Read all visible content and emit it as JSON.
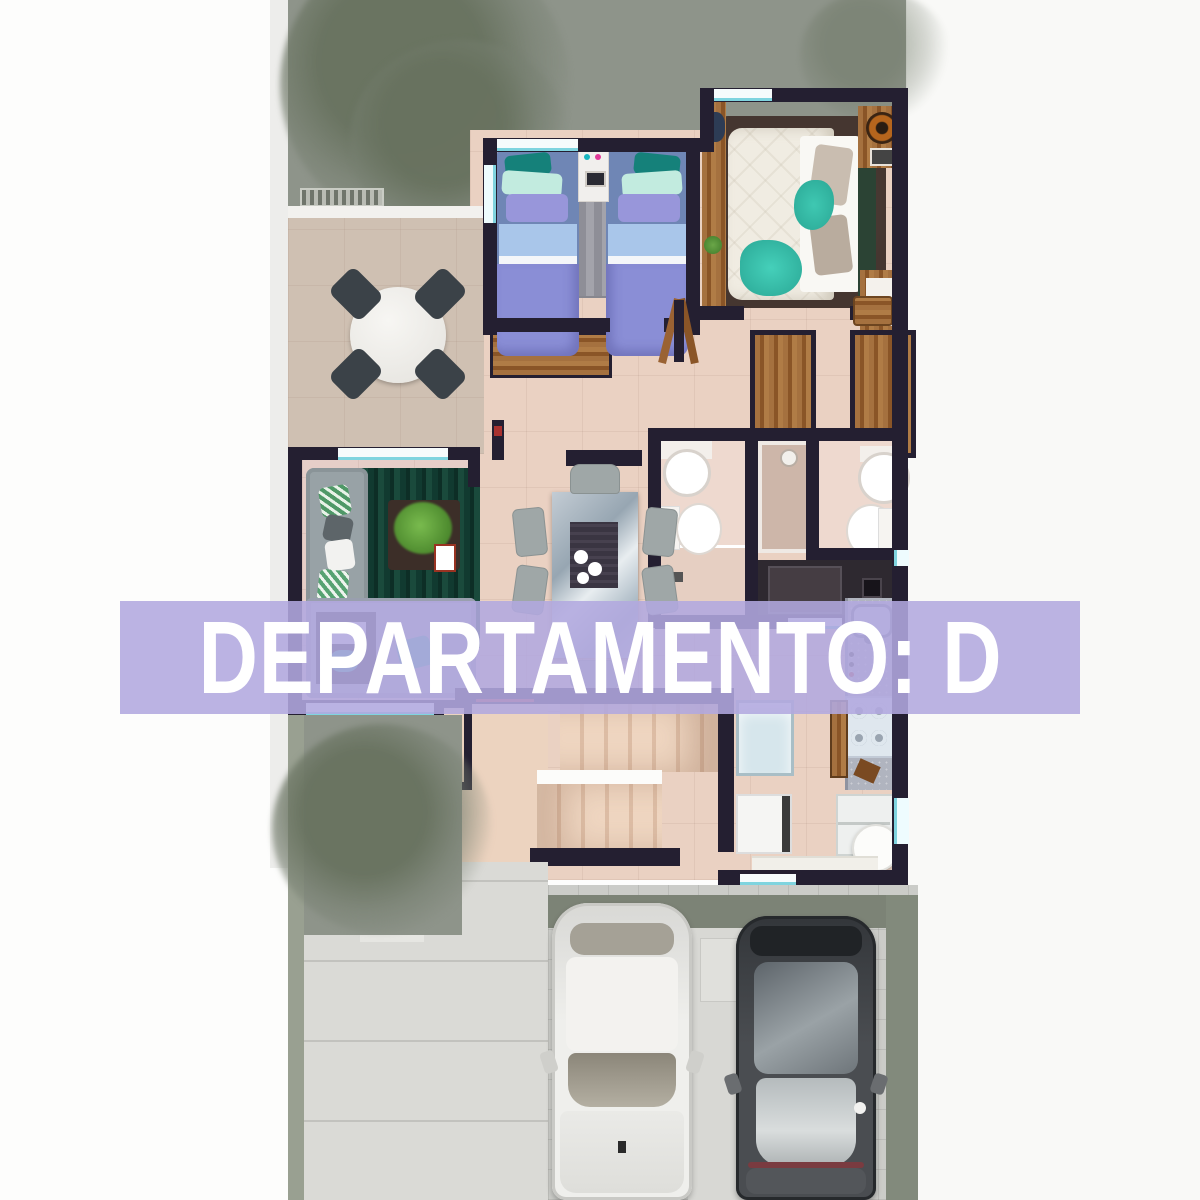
{
  "banner": {
    "text": "DEPARTAMENTO: D",
    "background_color": "#b2a9df",
    "text_color": "#ffffff"
  },
  "palette": {
    "wall": "#241f31",
    "interior_floor": "#ead1c2",
    "terrace_floor": "#cfc0b2",
    "lawn": "#8e948a",
    "tree_foliage": "#768070",
    "window_glass": "#7fd4df",
    "patio_paver": "#d9d9d5",
    "driveway_paver": "#cbccc8",
    "driveway_border": "#7c8376",
    "living_rug": "#113a30",
    "master_rug": "#4a3a33",
    "kids_bedding": "#8a8ed6",
    "master_bedding": "#f0ece2",
    "accent_teal": "#35c1ad",
    "kitchen_counter": "#b0b4bf",
    "wood": "#9a6233",
    "exterior_margin": "#fdfdfc"
  },
  "scene": {
    "type": "apartment floor plan render, top-down view",
    "rooms": [
      "garden",
      "terrace-dining",
      "kids-bedroom",
      "master-bedroom",
      "hallway",
      "bathroom-left",
      "shower-room",
      "bathroom-right",
      "closet",
      "living-room",
      "dining-area",
      "kitchen",
      "stairs",
      "entry",
      "utility-laundry",
      "patio",
      "driveway"
    ],
    "vehicles": 2,
    "beds": 3,
    "bathrooms": 2
  }
}
